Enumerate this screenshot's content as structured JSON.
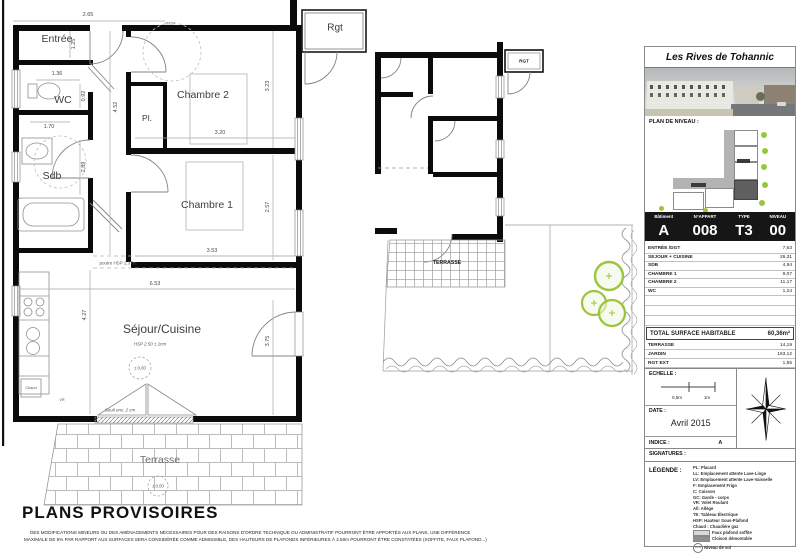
{
  "plan": {
    "rooms": {
      "entree": "Entrée",
      "wc": "WC",
      "sdb": "Sdb",
      "chambre1": "Chambre 1",
      "chambre2": "Chambre 2",
      "sejour": "Séjour/Cuisine",
      "placard": "Pl.",
      "rgt": "Rgt",
      "terrasse": "Terrasse"
    },
    "dims": {
      "entree_w": "2.65",
      "entree_h": "1.25",
      "wc_w": "1.36",
      "wc_h": "0.92",
      "sdb_w": "1.70",
      "sdb_h": "2.89",
      "hall_h": "4.52",
      "ch2_w": "3.20",
      "ch2_h": "3.23",
      "ch1_w": "3.53",
      "ch1_h": "2.57",
      "sejour_w": "6.53",
      "sejour_h": "4.27",
      "sejour_right_h": "3.75"
    },
    "notes": {
      "poutre": "poutre HSP 2.37m",
      "hsp": "HSP 2.50 ± 2cm",
      "seuil": "Seuil env. 2 cm",
      "niveau": "± 0.00",
      "circle": "Ø150",
      "chaud": "Chaud",
      "vr": "VR"
    }
  },
  "garden_plan": {
    "rgt": "RGT",
    "terrasse": "TERRASSE"
  },
  "panel": {
    "title": "Les Rives de Tohannic",
    "plan_niveau": "PLAN DE NIVEAU :",
    "apt_headers": [
      "Bâtiment",
      "N°APPART",
      "TYPE",
      "NIVEAU"
    ],
    "apt_values": [
      "A",
      "008",
      "T3",
      "00"
    ],
    "areas": [
      {
        "label": "ENTRÉE /DGT",
        "value": "7,63"
      },
      {
        "label": "SEJOUR + CUISINE",
        "value": "26,31"
      },
      {
        "label": "SDB",
        "value": "4,94"
      },
      {
        "label": "CHAMBRE 1",
        "value": "9,07"
      },
      {
        "label": "CHAMBRE 2",
        "value": "11,17"
      },
      {
        "label": "WC",
        "value": "1,24"
      }
    ],
    "total_label": "TOTAL SURFACE HABITABLE",
    "total_value": "60,36m²",
    "extras": [
      {
        "label": "TERRASSE",
        "value": "14,19"
      },
      {
        "label": "JARDIN",
        "value": "163,12"
      },
      {
        "label": "RGT EXT",
        "value": "1,55"
      }
    ],
    "echelle_label": "ECHELLE :",
    "scale_ticks": [
      "0,5m",
      "1m"
    ],
    "date_label": "DATE :",
    "date_value": "Avril 2015",
    "indice_label": "INDICE :",
    "indice_value": "A",
    "signatures_label": "SIGNATURES :",
    "legende_label": "LÉGENDE :",
    "legend_items": [
      "PL: Placard",
      "LL: Emplacement attente Lave-Linge",
      "LV: Emplacement attente Lave-Vaisselle",
      "F: Emplacement Frigo",
      "C: Cuisson",
      "GC: Garde - corps",
      "VR: Volet Roulant",
      "All: Allège",
      "TE: Tableau Électrique",
      "HSP: Hauteur Sous-Plafond",
      "Chaud : Chaudière gaz"
    ],
    "legend_swatches": [
      {
        "label": "Faux plafond soffite"
      },
      {
        "label": "Cloison démontable"
      }
    ],
    "legend_niveau": {
      "symbol": "±0.00",
      "label": "Niveau de sol"
    }
  },
  "footer": {
    "heading": "PLANS PROVISOIRES",
    "line1": "DES MODIFICATIONS MINEURS OU DES AMÉNAGEMENTS NÉCESSAIRES POUR DES RAISONS D'ORDRE TECHNIQUE OU ADMINISTRATIF POURRONT ÊTRE APPORTÉS AUX PLANS, UNE DIFFÉRENCE",
    "line2": "MAXIMALE DE 5% PAR RAPPORT AUX SURFACES SERA CONSIDÉRÉE COMME ADMISSIBLE, DES HAUTEURS DE PLAFONDS INFÉRIEURES À 2.50m POURRONT  ÊTRE CONSTATÉES (SOFFITE, FAUX PLAFOND...)"
  },
  "colors": {
    "wall": "#0b0b0b",
    "tree": "#9bc53d"
  }
}
